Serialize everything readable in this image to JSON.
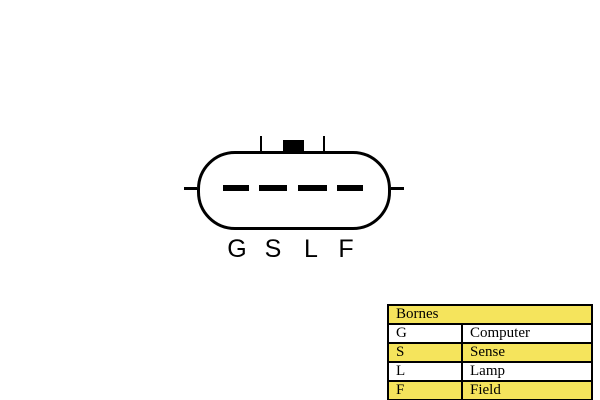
{
  "connector": {
    "pins": [
      {
        "label": "G"
      },
      {
        "label": "S"
      },
      {
        "label": "L"
      },
      {
        "label": "F"
      }
    ]
  },
  "legend": {
    "title": "Bornes",
    "highlight_color": "#F5E45C",
    "title_highlighted": true,
    "rows": [
      {
        "terminal": "G",
        "function": "Computer",
        "highlighted": false
      },
      {
        "terminal": "S",
        "function": "Sense",
        "highlighted": true
      },
      {
        "terminal": "L",
        "function": "Lamp",
        "highlighted": false
      },
      {
        "terminal": "F",
        "function": "Field",
        "highlighted": true
      }
    ]
  }
}
